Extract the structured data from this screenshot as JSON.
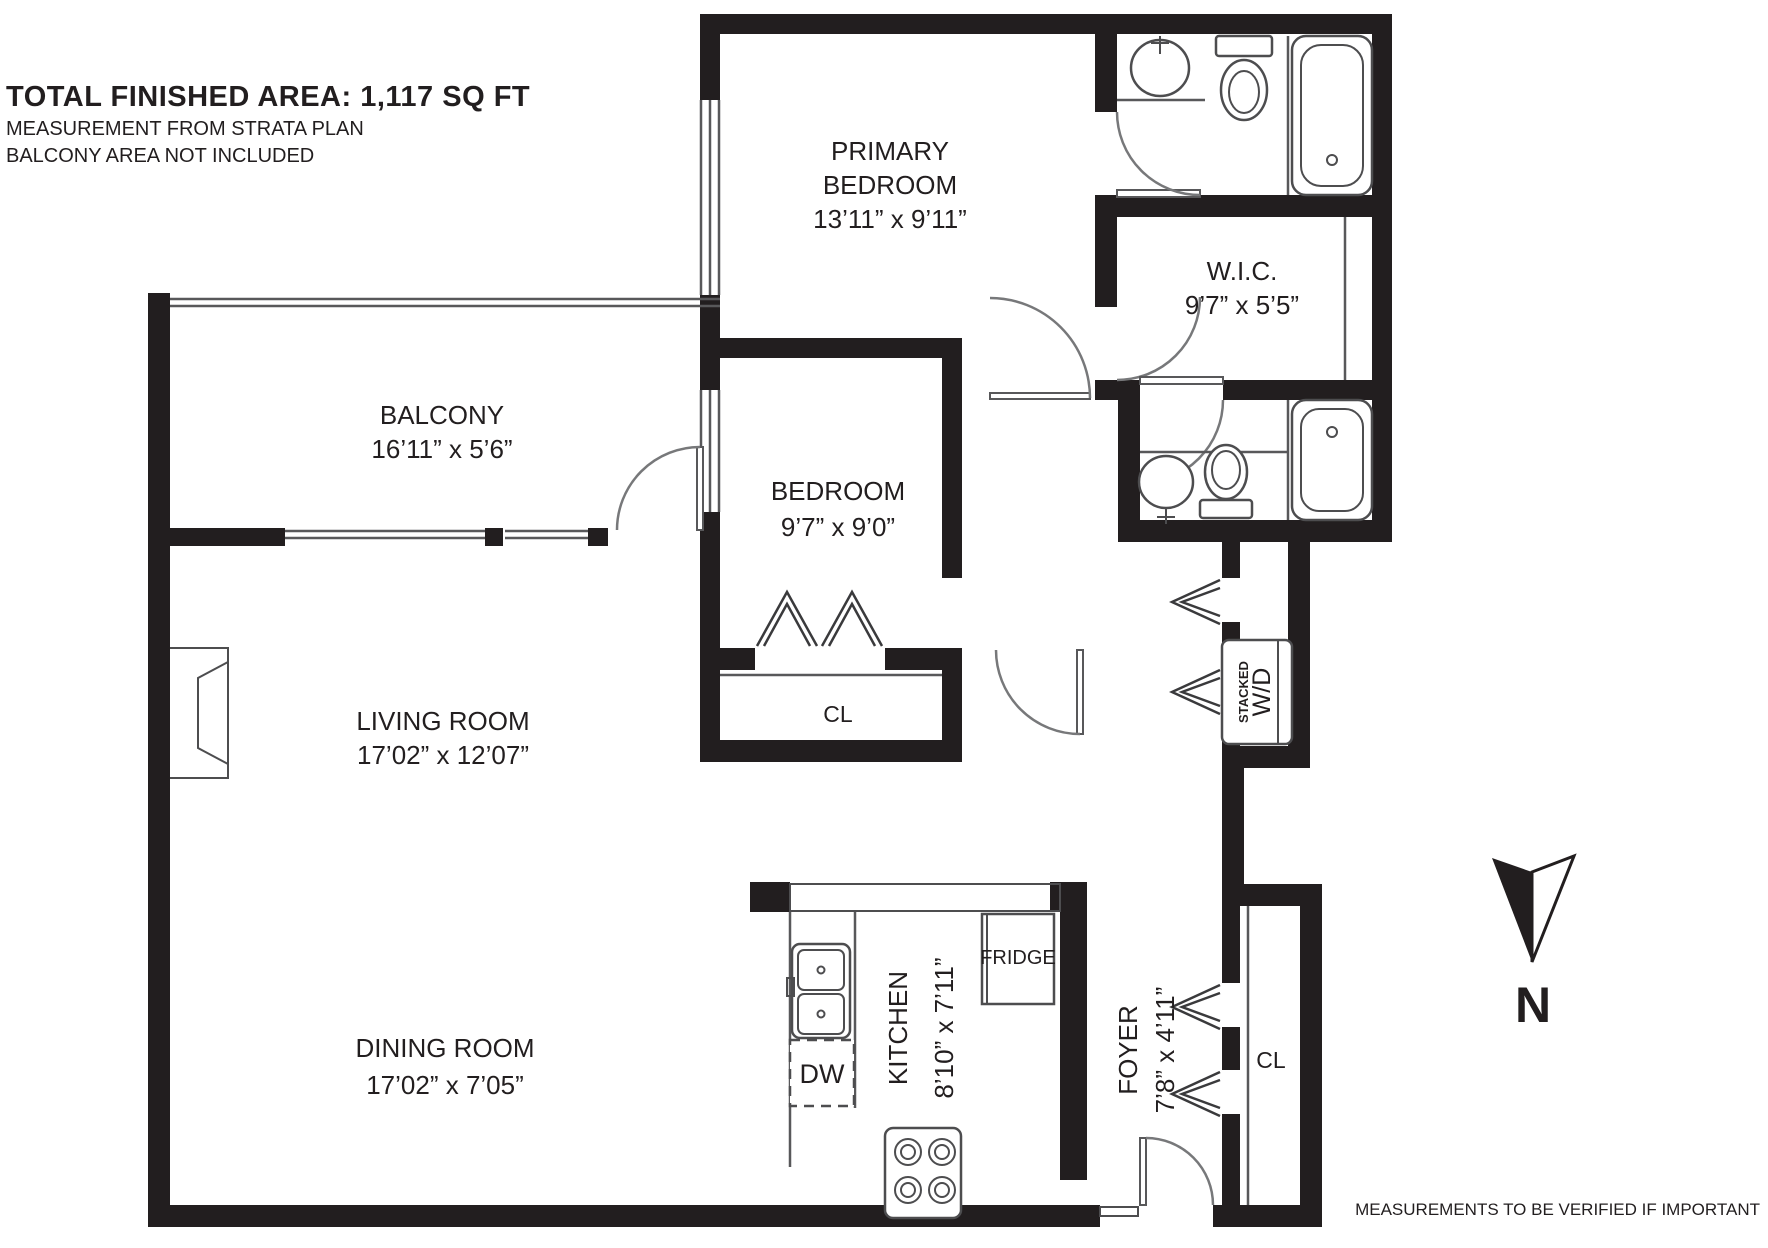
{
  "header": {
    "title": "TOTAL FINISHED AREA: 1,117 SQ FT",
    "line1": "MEASUREMENT FROM STRATA PLAN",
    "line2": "BALCONY AREA NOT INCLUDED"
  },
  "footer": {
    "note": "MEASUREMENTS TO BE VERIFIED IF IMPORTANT"
  },
  "compass": {
    "label": "N"
  },
  "rooms": {
    "primary_bedroom": {
      "line1": "PRIMARY",
      "line2": "BEDROOM",
      "dims": "13’11” x 9’11”"
    },
    "wic": {
      "name": "W.I.C.",
      "dims": "9’7” x 5’5”"
    },
    "balcony": {
      "name": "BALCONY",
      "dims": "16’11” x 5’6”"
    },
    "bedroom": {
      "name": "BEDROOM",
      "dims": "9’7” x 9’0”"
    },
    "living_room": {
      "name": "LIVING ROOM",
      "dims": "17’02” x 12’07”"
    },
    "dining_room": {
      "name": "DINING ROOM",
      "dims": "17’02” x 7’05”"
    },
    "kitchen": {
      "name": "KITCHEN",
      "dims": "8’10” x 7’11”"
    },
    "foyer": {
      "name": "FOYER",
      "dims": "7’8” x 4’11”"
    }
  },
  "labels": {
    "bedroom_closet": "CL",
    "foyer_closet": "CL",
    "fridge": "FRIDGE",
    "dishwasher": "DW",
    "stacked": "STACKED",
    "washer_dryer": "W/D"
  },
  "colors": {
    "wall": "#221e1f",
    "line": "#58585a",
    "text": "#221e1f",
    "background": "#ffffff"
  }
}
